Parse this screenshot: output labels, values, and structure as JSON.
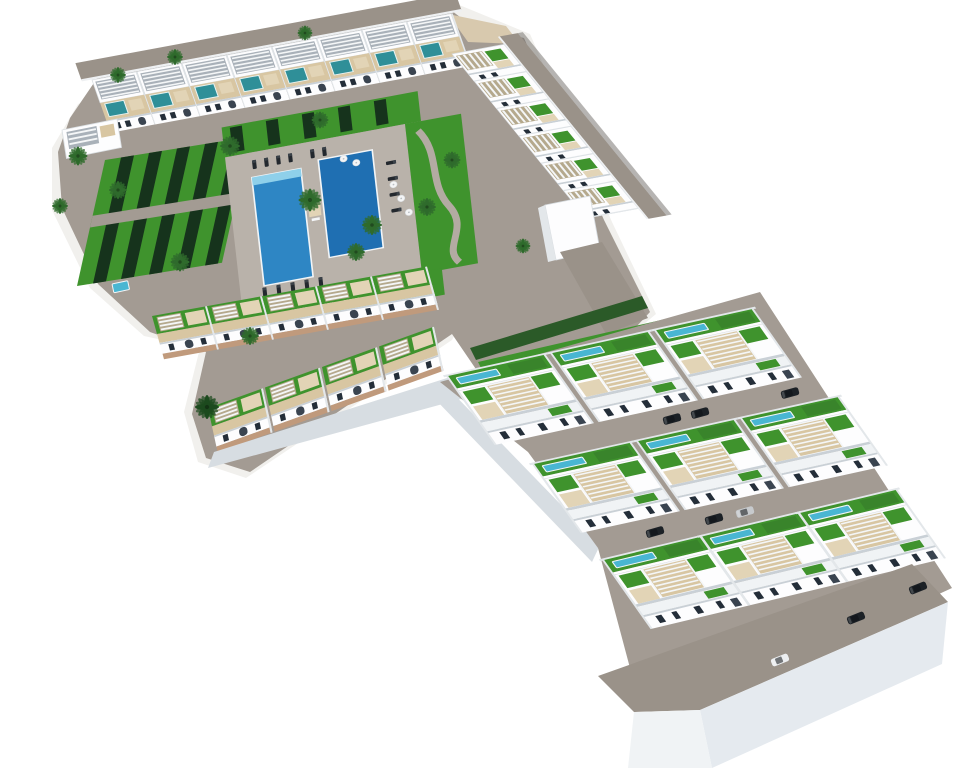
{
  "overview": {
    "kind": "3d-aerial-architectural-render",
    "subject": "residential development with communal pool courtyard, perimeter townhouses and three rows of detached villas on a raised plinth"
  },
  "colors": {
    "background": "#ffffff",
    "apron": "#f1f0ed",
    "paving": "#a39b93",
    "road": "#9a9289",
    "paving_light": "#b9b2aa",
    "deck": "#d8c6a2",
    "deck_light": "#e2d4b6",
    "pergola_shade": "#a9b1b9",
    "pergola_slat": "#f4f6f7",
    "pergola_base": "#b5a98d",
    "lawn": "#3f932d",
    "lawn_dark": "#2e6b27",
    "stripe_dark": "#16331c",
    "hedge": "#2b5a28",
    "pool_blue": "#2e86c4",
    "pool_deep": "#1f6fb2",
    "pool_steps": "#8fd0ea",
    "roof_pool": "#2f8f98",
    "lap_pool": "#49b6d2",
    "wall_white": "#fdfdfe",
    "wall_shade": "#c9d0d6",
    "wall_light": "#e3e7ea",
    "window": "#242e39",
    "door": "#3a4450",
    "terracotta": "#c09a7c",
    "sand": "#d8c9ae",
    "plinth_front": "#e5eaef",
    "plinth_side": "#f0f3f5",
    "plinth_edge": "#d7dde2",
    "shadow": "#6e6a66",
    "white_curb": "#eef0f2",
    "car_dark": "#1c2126",
    "car_grey": "#c7cacd",
    "car_white": "#eceef0",
    "palm_green": "#2f6b2c",
    "palm_dark": "#1d4a1e",
    "trunk": "#8a6b4a"
  },
  "inventory": {
    "townhouses_north_row": 8,
    "townhouses_east_row": 6,
    "townhouses_south_row_a": 5,
    "townhouses_south_row_b": 4,
    "villa_clusters": 9,
    "communal_pool_basins": 2,
    "rooftop_plunge_pools": 8,
    "villa_lap_pools": 9,
    "sun_loungers": 15,
    "shade_cabanas": 3,
    "parasols": 5,
    "palm_trees": 17,
    "parked_cars": 9
  },
  "scene": {
    "stamps": [
      {
        "symbol": "townhouse-north",
        "into": "row-north",
        "count": 8,
        "start": [
          0,
          0
        ],
        "step": [
          45,
          0
        ]
      },
      {
        "symbol": "townhouse-east",
        "into": "row-east",
        "count": 6,
        "start": [
          0,
          0
        ],
        "step": [
          0,
          36
        ]
      },
      {
        "symbol": "townhouse-south",
        "into": "row-south-a",
        "count": 5,
        "start": [
          0,
          0
        ],
        "step": [
          55,
          0
        ]
      },
      {
        "symbol": "townhouse-south",
        "into": "row-south-b",
        "count": 4,
        "start": [
          0,
          0
        ],
        "step": [
          57,
          0
        ]
      },
      {
        "symbol": "villa",
        "into": "villa-row-1",
        "count": 3,
        "start": [
          0,
          0
        ],
        "step": [
          104,
          0
        ]
      },
      {
        "symbol": "villa",
        "into": "villa-row-2",
        "count": 3,
        "start": [
          0,
          0
        ],
        "step": [
          104,
          0
        ]
      },
      {
        "symbol": "villa",
        "into": "villa-row-3",
        "count": 3,
        "start": [
          0,
          0
        ],
        "step": [
          98,
          0
        ]
      },
      {
        "symbol": "lounger",
        "into": "pool-area",
        "items": [
          [
            12,
            44
          ],
          [
            24,
            44
          ],
          [
            36,
            44
          ],
          [
            48,
            44
          ],
          [
            70,
            44
          ],
          [
            82,
            44
          ],
          [
            146,
            70,
            90
          ],
          [
            146,
            88,
            90
          ],
          [
            146,
            106,
            90
          ],
          [
            146,
            124,
            90
          ],
          [
            8,
            188
          ],
          [
            22,
            188
          ],
          [
            36,
            188
          ],
          [
            50,
            188
          ],
          [
            64,
            188
          ]
        ]
      },
      {
        "symbol": "cabana",
        "into": "pool-area",
        "items": [
          [
            40,
            208
          ],
          [
            66,
            208
          ],
          [
            92,
            208
          ]
        ]
      },
      {
        "symbol": "parasol",
        "into": "pool-area",
        "items": [
          [
            100,
            56
          ],
          [
            112,
            63
          ],
          [
            146,
            95
          ],
          [
            152,
            112
          ],
          [
            158,
            129
          ]
        ]
      },
      {
        "symbol": "palm",
        "into": "decor",
        "color": "palm_green",
        "items": [
          [
            310,
            200,
            0,
            1.15
          ],
          [
            372,
            225,
            0,
            1.0
          ],
          [
            356,
            252,
            0,
            0.9
          ],
          [
            427,
            207,
            0,
            0.9
          ],
          [
            452,
            160,
            0,
            0.85
          ],
          [
            320,
            120,
            0,
            0.85
          ],
          [
            230,
            146,
            0,
            1.0
          ],
          [
            180,
            262,
            0,
            0.95
          ],
          [
            118,
            190,
            0,
            0.9
          ],
          [
            78,
            156,
            0,
            0.95
          ],
          [
            60,
            206,
            0,
            0.8
          ],
          [
            250,
            336,
            0,
            0.9
          ],
          [
            175,
            57,
            0,
            0.8
          ],
          [
            305,
            33,
            0,
            0.75
          ],
          [
            118,
            75,
            0,
            0.8
          ],
          [
            523,
            246,
            0,
            0.75
          ]
        ]
      },
      {
        "symbol": "palm",
        "into": "decor",
        "color": "palm_dark",
        "items": [
          [
            207,
            407,
            0,
            1.2
          ]
        ]
      },
      {
        "symbol": "car",
        "into": "decor",
        "color": "car_dark",
        "items": [
          [
            918,
            588,
            -22
          ],
          [
            856,
            618,
            -22
          ],
          [
            655,
            532,
            -16
          ],
          [
            714,
            519,
            -16
          ],
          [
            790,
            393,
            -15
          ],
          [
            672,
            419,
            -15
          ],
          [
            700,
            413,
            -15
          ]
        ]
      },
      {
        "symbol": "car",
        "into": "decor",
        "color": "car_white",
        "items": [
          [
            780,
            660,
            -22
          ]
        ]
      },
      {
        "symbol": "car",
        "into": "decor",
        "color": "car_grey",
        "items": [
          [
            745,
            512,
            -16
          ]
        ]
      }
    ]
  }
}
